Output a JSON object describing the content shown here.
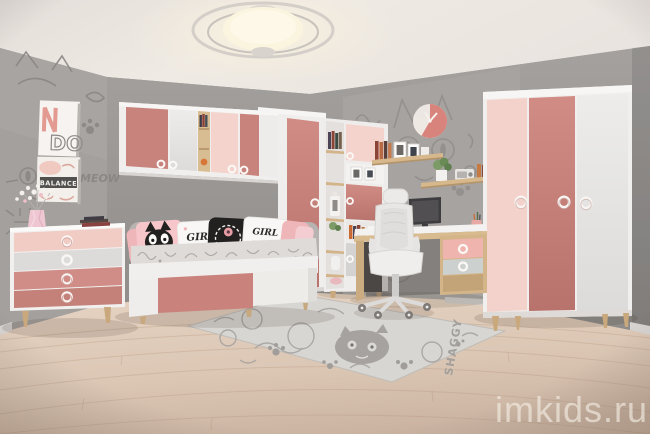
{
  "watermark": {
    "text": "imkids.ru"
  },
  "posters": {
    "top": {
      "text": "DO"
    },
    "bottom": {
      "text": "BALANCE"
    }
  },
  "wallpaper": {
    "word": "MEOW"
  },
  "pillows": {
    "girl_power_left": {
      "line1": "GIRL",
      "line2": "power"
    },
    "girl_power_right": {
      "line1": "GIRL",
      "line2": "power"
    }
  },
  "rug": {
    "label": "SHAGGY"
  },
  "colors": {
    "rose": "#c9837d",
    "pink_light": "#f3d2cb",
    "furniture_white": "#f1efed",
    "wall_gray": "#9d9a97",
    "wallpaper_doodle": "#8b8785",
    "wood": "#d2b288",
    "floor_wood": "#ddc9b8",
    "clock_pink": "#d8837b",
    "pillow_black": "#232020"
  }
}
